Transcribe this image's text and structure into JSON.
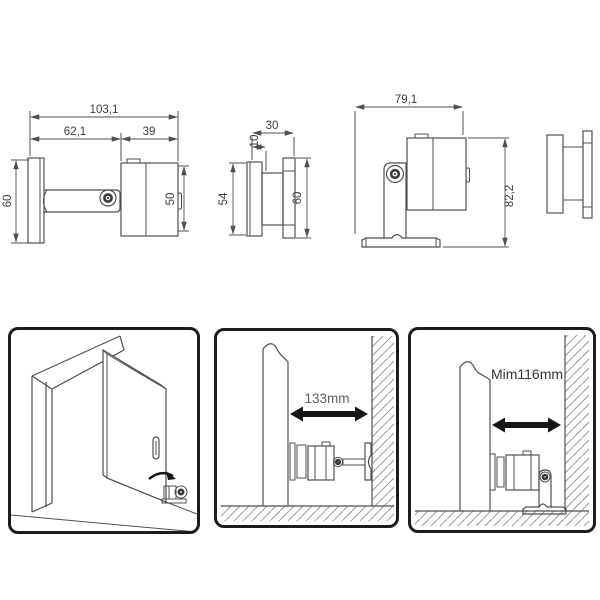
{
  "colors": {
    "line": "#4f4f4f",
    "dimension_text": "#3c3c3c",
    "panel_border": "#1c1c1c",
    "arrow_black": "#161616",
    "hatch": "#9a9a9a"
  },
  "views": {
    "side": {
      "dim_total_length": "103,1",
      "dim_arm_section": "62,1",
      "dim_body_section": "39",
      "dim_plate_height": "60",
      "dim_body_height": "50"
    },
    "front": {
      "dim_top_width": "30",
      "dim_step_width": "10",
      "dim_left_height": "54",
      "dim_right_height": "60"
    },
    "floor": {
      "dim_width": "79,1",
      "dim_height": "82,2"
    }
  },
  "panels": {
    "wall_clearance": {
      "caption": "133mm"
    },
    "floor_clearance": {
      "caption": "Mim116mm"
    }
  }
}
